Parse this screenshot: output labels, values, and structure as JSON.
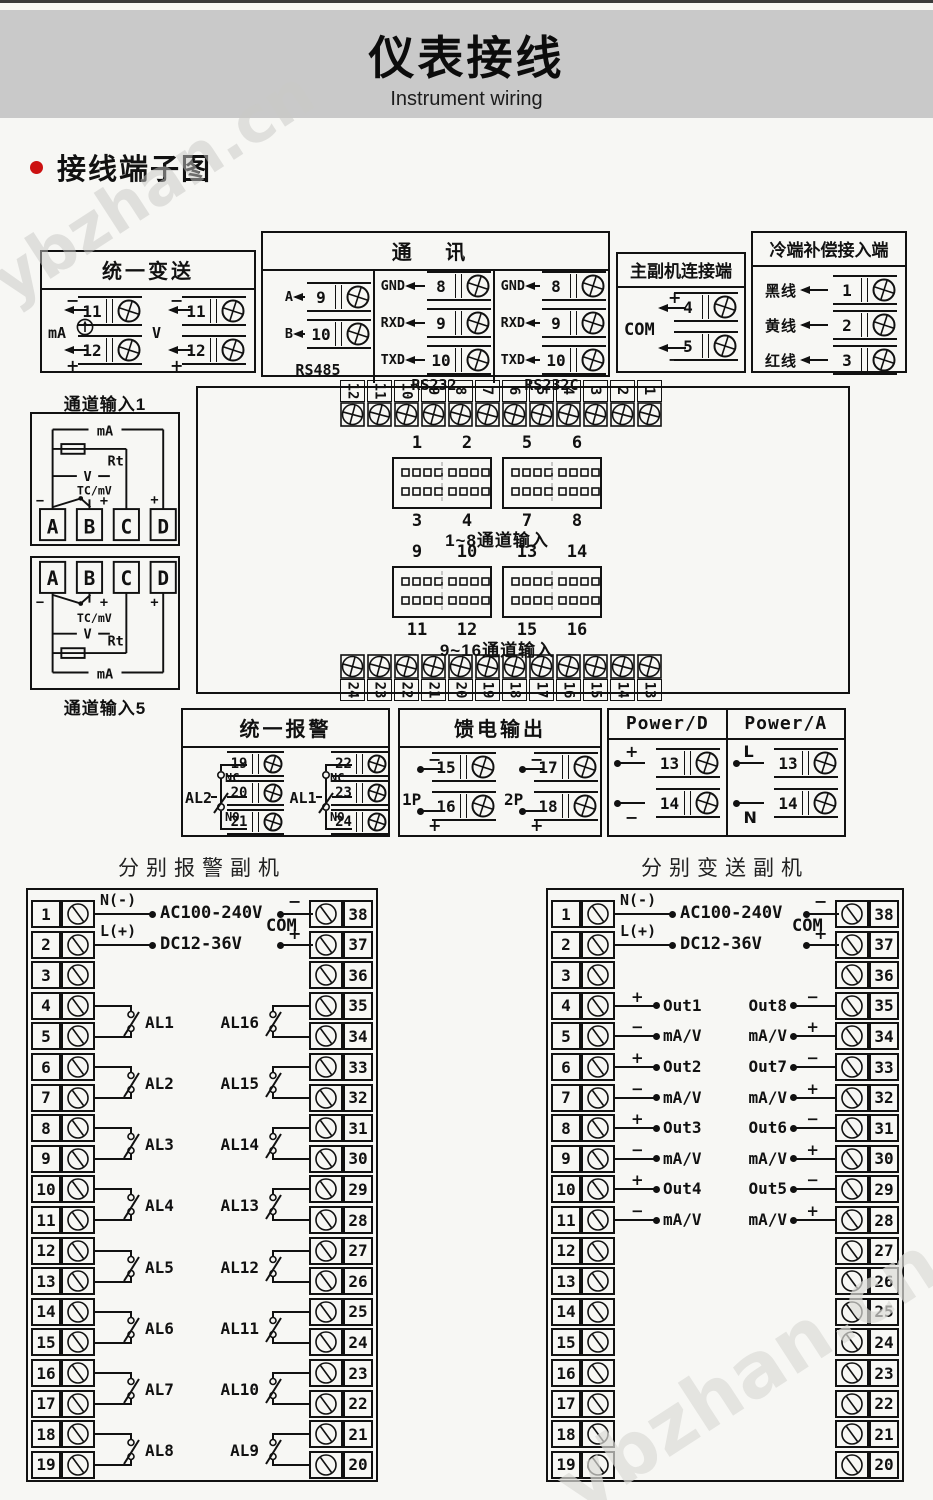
{
  "watermark": "ybzhan.cn",
  "page": {
    "title": "仪表接线",
    "subtitle": "Instrument wiring",
    "section_title": "接线端子图"
  },
  "unified_transmit": {
    "title": "统一变送",
    "groups": [
      {
        "label": "mA",
        "minus": "−",
        "plus": "+",
        "terms": [
          "11",
          "12"
        ]
      },
      {
        "label": "V",
        "minus": "−",
        "plus": "+",
        "terms": [
          "11",
          "12"
        ]
      }
    ]
  },
  "comm": {
    "title": "通  讯",
    "cols": [
      {
        "name": "RS485",
        "rows": [
          {
            "label": "A",
            "num": "9"
          },
          {
            "label": "B",
            "num": "10"
          }
        ]
      },
      {
        "name": "RS232",
        "rows": [
          {
            "label": "GND",
            "num": "8"
          },
          {
            "label": "RXD",
            "num": "9"
          },
          {
            "label": "TXD",
            "num": "10"
          }
        ]
      },
      {
        "name": "RS232C",
        "rows": [
          {
            "label": "GND",
            "num": "8"
          },
          {
            "label": "RXD",
            "num": "9"
          },
          {
            "label": "TXD",
            "num": "10"
          }
        ]
      }
    ]
  },
  "master_slave": {
    "title": "主副机连接端",
    "com_label": "COM",
    "rows": [
      {
        "sign": "+",
        "num": "4"
      },
      {
        "sign": "−",
        "num": "5"
      }
    ]
  },
  "cold_comp": {
    "title": "冷端补偿接入端",
    "rows": [
      {
        "label": "黑线",
        "num": "1"
      },
      {
        "label": "黄线",
        "num": "2"
      },
      {
        "label": "红线",
        "num": "3"
      }
    ]
  },
  "channel_input_1": {
    "title": "通道输入1",
    "ma": "mA",
    "rt": "Rt",
    "v": "V",
    "tc": "TC/mV",
    "minus": "−",
    "plus": "+",
    "terminals": [
      "A",
      "B",
      "C",
      "D"
    ]
  },
  "channel_input_5": {
    "title": "通道输入5",
    "ma": "mA",
    "rt": "Rt",
    "v": "V",
    "tc": "TC/mV",
    "minus": "−",
    "plus": "+",
    "terminals": [
      "A",
      "B",
      "C",
      "D"
    ]
  },
  "center_block": {
    "top_strip": [
      "12",
      "11",
      "10",
      "9",
      "8",
      "7",
      "6",
      "5",
      "4",
      "3",
      "2",
      "1"
    ],
    "bottom_strip": [
      "24",
      "23",
      "22",
      "21",
      "20",
      "19",
      "18",
      "17",
      "16",
      "15",
      "14",
      "13"
    ],
    "groups": [
      {
        "caption": "1~8通道输入",
        "sockets": [
          {
            "top": [
              "1",
              "2"
            ],
            "bottom": [
              "3",
              "4"
            ]
          },
          {
            "top": [
              "5",
              "6"
            ],
            "bottom": [
              "7",
              "8"
            ]
          }
        ]
      },
      {
        "caption": "9~16通道输入",
        "sockets": [
          {
            "top": [
              "9",
              "10"
            ],
            "bottom": [
              "11",
              "12"
            ]
          },
          {
            "top": [
              "13",
              "14"
            ],
            "bottom": [
              "15",
              "16"
            ]
          }
        ]
      }
    ]
  },
  "unified_alarm": {
    "title": "统一报警",
    "groups": [
      {
        "label": "AL2",
        "nc": "NC",
        "no": "NO",
        "terms": [
          "19",
          "20",
          "21"
        ]
      },
      {
        "label": "AL1",
        "nc": "NC",
        "no": "NO",
        "terms": [
          "22",
          "23",
          "24"
        ]
      }
    ]
  },
  "feed_output": {
    "title": "馈电输出",
    "groups": [
      {
        "label": "1P",
        "rows": [
          {
            "sign": "−",
            "num": "15"
          },
          {
            "sign": "+",
            "num": "16"
          }
        ]
      },
      {
        "label": "2P",
        "rows": [
          {
            "sign": "−",
            "num": "17"
          },
          {
            "sign": "+",
            "num": "18"
          }
        ]
      }
    ]
  },
  "power_block": {
    "cols": [
      {
        "title": "Power/D",
        "rows": [
          {
            "sign": "+",
            "num": "13"
          },
          {
            "sign": "−",
            "num": "14"
          }
        ]
      },
      {
        "title": "Power/A",
        "rows": [
          {
            "sign": "L",
            "num": "13"
          },
          {
            "sign": "N",
            "num": "14"
          }
        ]
      }
    ]
  },
  "alarm_slave": {
    "title": "分别报警副机",
    "supply": {
      "n": "N(-)",
      "l": "L(+)",
      "line1": "AC100-240V",
      "line2": "DC12-36V"
    },
    "com": {
      "label": "COM",
      "minus": "−",
      "plus": "+"
    },
    "left_terms": [
      "1",
      "2",
      "3",
      "4",
      "5",
      "6",
      "7",
      "8",
      "9",
      "10",
      "11",
      "12",
      "13",
      "14",
      "15",
      "16",
      "17",
      "18",
      "19"
    ],
    "right_terms": [
      "38",
      "37",
      "36",
      "35",
      "34",
      "33",
      "32",
      "31",
      "30",
      "29",
      "28",
      "27",
      "26",
      "25",
      "24",
      "23",
      "22",
      "21",
      "20"
    ],
    "left_pairs": [
      {
        "label": "AL1",
        "row": 3
      },
      {
        "label": "AL2",
        "row": 5
      },
      {
        "label": "AL3",
        "row": 7
      },
      {
        "label": "AL4",
        "row": 9
      },
      {
        "label": "AL5",
        "row": 11
      },
      {
        "label": "AL6",
        "row": 13
      },
      {
        "label": "AL7",
        "row": 15
      },
      {
        "label": "AL8",
        "row": 17
      }
    ],
    "right_pairs": [
      {
        "label": "AL16",
        "row": 3
      },
      {
        "label": "AL15",
        "row": 5
      },
      {
        "label": "AL14",
        "row": 7
      },
      {
        "label": "AL13",
        "row": 9
      },
      {
        "label": "AL12",
        "row": 11
      },
      {
        "label": "AL11",
        "row": 13
      },
      {
        "label": "AL10",
        "row": 15
      },
      {
        "label": "AL9",
        "row": 17
      }
    ]
  },
  "transmit_slave": {
    "title": "分别变送副机",
    "supply": {
      "n": "N(-)",
      "l": "L(+)",
      "line1": "AC100-240V",
      "line2": "DC12-36V"
    },
    "com": {
      "label": "COM",
      "minus": "−",
      "plus": "+"
    },
    "left_terms": [
      "1",
      "2",
      "3",
      "4",
      "5",
      "6",
      "7",
      "8",
      "9",
      "10",
      "11",
      "12",
      "13",
      "14",
      "15",
      "16",
      "17",
      "18",
      "19"
    ],
    "right_terms": [
      "38",
      "37",
      "36",
      "35",
      "34",
      "33",
      "32",
      "31",
      "30",
      "29",
      "28",
      "27",
      "26",
      "25",
      "24",
      "23",
      "22",
      "21",
      "20"
    ],
    "left_pairs": [
      {
        "out": "Out1",
        "sub": "mA/V",
        "sign_top": "+",
        "sign_bottom": "−",
        "row": 3
      },
      {
        "out": "Out2",
        "sub": "mA/V",
        "sign_top": "+",
        "sign_bottom": "−",
        "row": 5
      },
      {
        "out": "Out3",
        "sub": "mA/V",
        "sign_top": "+",
        "sign_bottom": "−",
        "row": 7
      },
      {
        "out": "Out4",
        "sub": "mA/V",
        "sign_top": "+",
        "sign_bottom": "−",
        "row": 9
      }
    ],
    "right_pairs": [
      {
        "out": "Out8",
        "sub": "mA/V",
        "sign_top": "−",
        "sign_bottom": "+",
        "row": 3
      },
      {
        "out": "Out7",
        "sub": "mA/V",
        "sign_top": "−",
        "sign_bottom": "+",
        "row": 5
      },
      {
        "out": "Out6",
        "sub": "mA/V",
        "sign_top": "−",
        "sign_bottom": "+",
        "row": 7
      },
      {
        "out": "Out5",
        "sub": "mA/V",
        "sign_top": "−",
        "sign_bottom": "+",
        "row": 9
      }
    ]
  }
}
